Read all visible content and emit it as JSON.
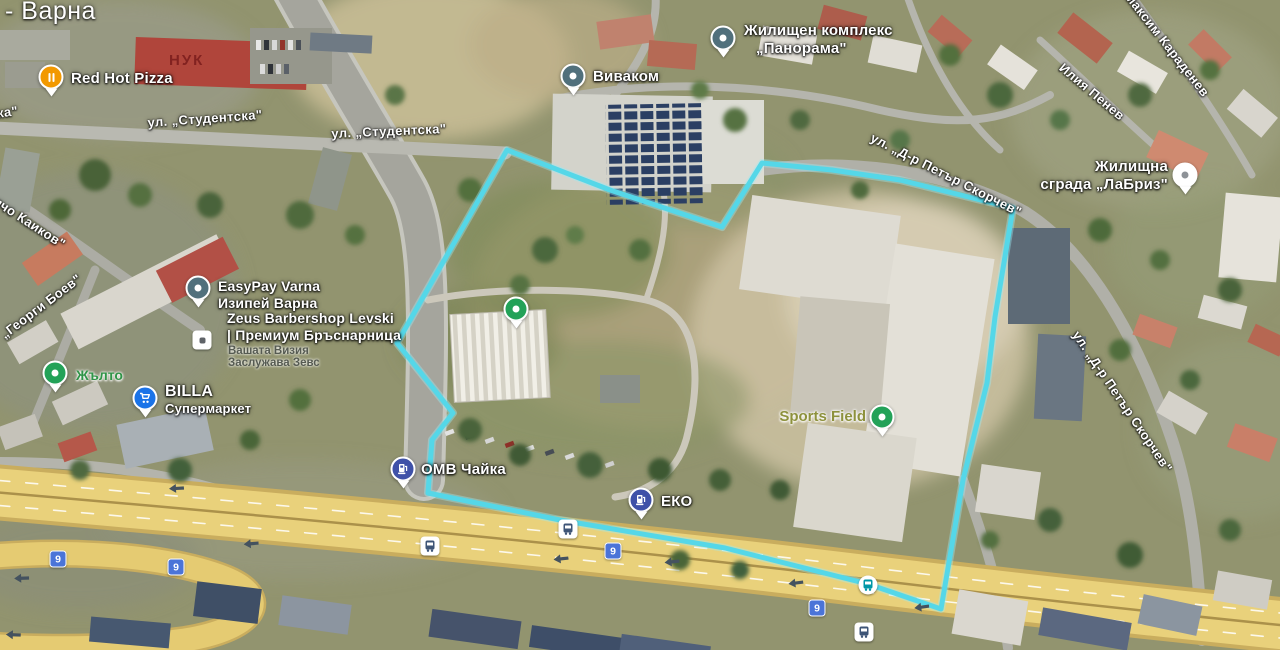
{
  "map": {
    "kind": "google-maps-satellite-view",
    "boundary_color": "#55d7e8",
    "highway_color": "#e9d17b",
    "route_shield_color": "#4b74d8"
  },
  "city_label": "- Варна",
  "streets": {
    "studentska_partial": "ка\"",
    "studentska_1": "ул. „Студентска\"",
    "studentska_2": "ул. „Студентска\"",
    "delcho_kaikov": "Делчо Каиков\"",
    "georgi_boev": "„Георги Боев\"",
    "skorchev_1": "ул. „Д-р Петър Скорчев\"",
    "skorchev_2": "ул. „Д-р Петър Скорчев\"",
    "maksim_karadenev": "Д-р Максим Караденев",
    "iliya_penev": "Илия Пенев"
  },
  "route_shield": {
    "label": "9"
  },
  "pois": {
    "red_hot_pizza": {
      "label": "Red Hot Pizza",
      "icon": "restaurant-icon",
      "pin_color": "#f29900"
    },
    "nuk": {
      "label": "НУК"
    },
    "vivacom": {
      "label": "Виваком",
      "icon": "place-dot-icon",
      "pin_color": "#51707c"
    },
    "panorama": {
      "line1": "Жилищен комплекс",
      "line2": "„Панорама\"",
      "icon": "place-dot-icon",
      "pin_color": "#51707c"
    },
    "labriz": {
      "line1": "Жилищна",
      "line2": "сграда „ЛаБриз\"",
      "icon": "place-dot-icon",
      "pin_color": "#ffffff"
    },
    "easypay": {
      "line1": "EasyPay Varna",
      "line2": "Изипей Варна",
      "icon": "place-dot-icon",
      "pin_color": "#51707c"
    },
    "zeus": {
      "line1": "Zeus Barbershop Levski",
      "line2": "| Премиум Бръснарница",
      "line3": "Вашата Визия",
      "line4": "Заслужава Зевс",
      "icon": "scissors-icon"
    },
    "zhalto": {
      "label": "Жълто",
      "icon": "place-dot-icon",
      "pin_color": "#23a258"
    },
    "billa": {
      "line1": "BILLA",
      "line2": "Супермаркет",
      "icon": "shopping-cart-icon",
      "pin_color": "#1a73e8"
    },
    "omv": {
      "label": "ОМВ Чайка",
      "icon": "fuel-pump-icon",
      "pin_color": "#3f51a8"
    },
    "eko": {
      "label": "ЕКО",
      "icon": "fuel-pump-icon",
      "pin_color": "#3f51a8"
    },
    "sports_field": {
      "label": "Sports Field",
      "icon": "place-dot-icon",
      "pin_color": "#23a258"
    },
    "unnamed_green_place": {
      "icon": "place-dot-icon",
      "pin_color": "#23a258"
    }
  },
  "transit": {
    "bus_stop_icon": "bus-icon"
  },
  "traffic": {
    "direction_arrow_icon": "left-arrow-icon"
  }
}
